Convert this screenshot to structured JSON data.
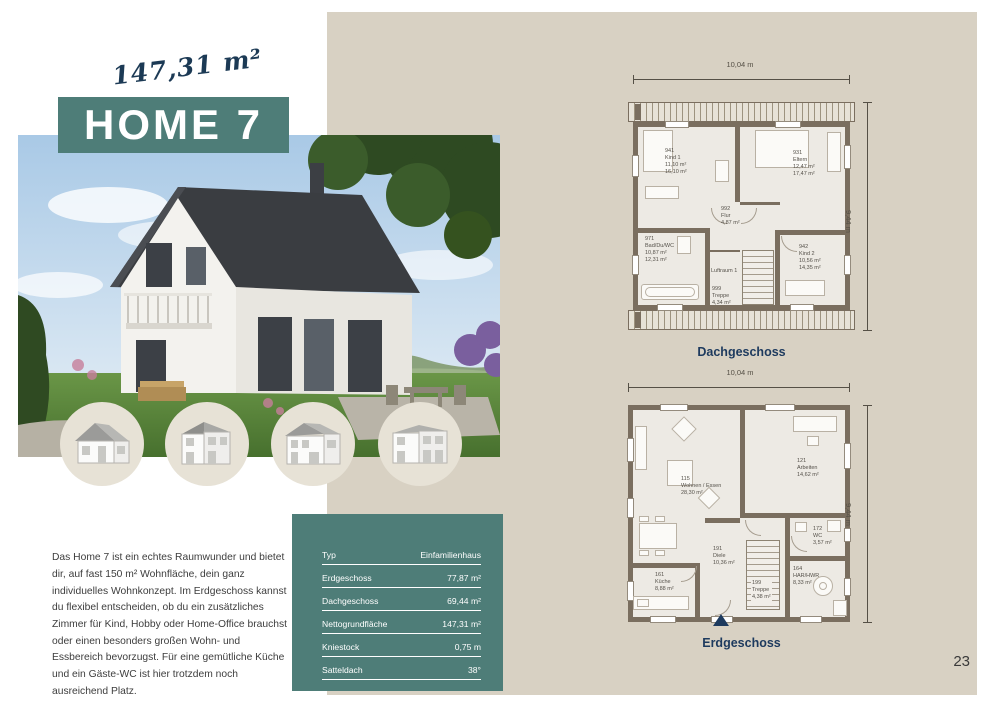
{
  "colors": {
    "accent_teal": "#4e7d78",
    "panel_beige": "#d8d1c3",
    "navy": "#1d3a5e"
  },
  "page": {
    "number": "23"
  },
  "header": {
    "area_label": "147,31 m²",
    "title": "HOME 7"
  },
  "description": "Das Home 7 ist ein echtes Raumwunder und bietet dir, auf fast 150 m² Wohnfläche, dein ganz individuelles Wohnkonzept. Im Erdgeschoss kannst du flexibel entscheiden, ob du ein zusätzliches Zimmer für Kind, Hobby oder Home-Office brauchst oder einen besonders großen Wohn- und Essbereich bevorzugst. Für eine gemütliche Küche und ein Gäste-WC ist hier trotzdem noch ausreichend Platz.",
  "variant_icons": [
    "gable-house-icon",
    "two-storey-house-icon",
    "wide-gable-house-icon",
    "flat-roof-house-icon"
  ],
  "spec_table": {
    "rows": [
      {
        "label": "Typ",
        "value": "Einfamilienhaus"
      },
      {
        "label": "Erdgeschoss",
        "value": "77,87 m²"
      },
      {
        "label": "Dachgeschoss",
        "value": "69,44 m²"
      },
      {
        "label": "Nettogrundfläche",
        "value": "147,31 m²"
      },
      {
        "label": "Kniestock",
        "value": "0,75 m"
      },
      {
        "label": "Satteldach",
        "value": "38°"
      }
    ]
  },
  "plans": {
    "dachgeschoss": {
      "title": "Dachgeschoss",
      "width_dim": "10,04 m",
      "height_dim": "9,44 m",
      "rooms": [
        {
          "id": "941",
          "name": "Kind 1",
          "area1": "11,10 m²",
          "area2": "16,10 m²"
        },
        {
          "id": "931",
          "name": "Eltern",
          "area1": "12,47 m²",
          "area2": "17,47 m²"
        },
        {
          "id": "992",
          "name": "Flur",
          "area1": "4,87 m²",
          "area2": ""
        },
        {
          "id": "971",
          "name": "Bad/Du/WC",
          "area1": "10,87 m²",
          "area2": "12,31 m²"
        },
        {
          "id": "",
          "name": "Luftraum 1",
          "area1": "",
          "area2": ""
        },
        {
          "id": "942",
          "name": "Kind 2",
          "area1": "10,56 m²",
          "area2": "14,35 m²"
        },
        {
          "id": "999",
          "name": "Treppe",
          "area1": "4,34 m²",
          "area2": ""
        }
      ]
    },
    "erdgeschoss": {
      "title": "Erdgeschoss",
      "width_dim": "10,04 m",
      "height_dim": "9,44 m",
      "rooms": [
        {
          "id": "115",
          "name": "Wohnen / Essen",
          "area1": "28,30 m²"
        },
        {
          "id": "121",
          "name": "Arbeiten",
          "area1": "14,62 m²"
        },
        {
          "id": "172",
          "name": "WC",
          "area1": "3,57 m²"
        },
        {
          "id": "191",
          "name": "Diele",
          "area1": "10,36 m²"
        },
        {
          "id": "161",
          "name": "Küche",
          "area1": "8,88 m²"
        },
        {
          "id": "199",
          "name": "Treppe",
          "area1": "4,38 m²"
        },
        {
          "id": "164",
          "name": "HAR/HWR",
          "area1": "8,33 m²"
        }
      ]
    }
  }
}
